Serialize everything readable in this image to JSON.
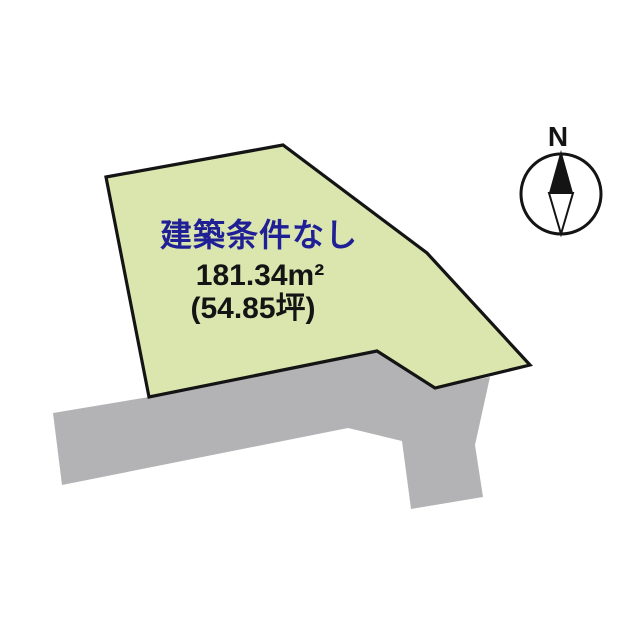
{
  "page": {
    "background": "#ffffff"
  },
  "parcel": {
    "condition": "建築条件なし",
    "area_sqm": "181.34m²",
    "area_tsubo": "(54.85坪)",
    "fill": "#dbe6af",
    "stroke": "#141414",
    "condition_color": "#202096",
    "points": "106,177 283,145 427,253 530,365 435,388 377,351 149,397"
  },
  "road": {
    "fill": "#b3b3b5",
    "points": "53,413 149,397 377,351 437,388 490,377 475,445 483,497 411,509 402,441 348,428 62,485"
  },
  "compass": {
    "label": "N",
    "color": "#141414",
    "circle": {
      "cx": 561,
      "cy": 194,
      "r": 40
    },
    "needle_north": "561,150 573,193 549,193",
    "needle_south": "549,193 573,193 561,234"
  }
}
